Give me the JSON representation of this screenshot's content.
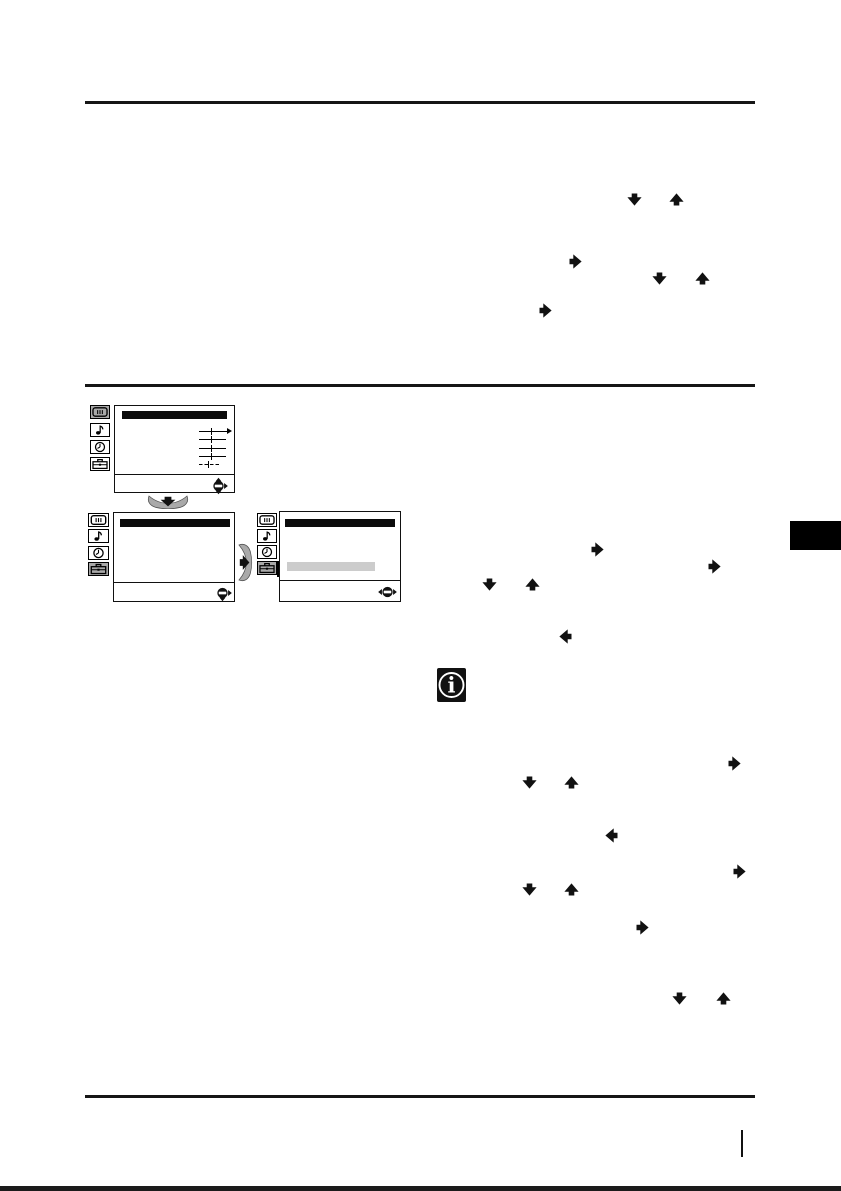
{
  "page": {
    "kind": "scanned TV instruction manual page",
    "background_color": "#ffffff",
    "ink_color": "#111111",
    "visible_text": "",
    "page_number_mark_glyph": "|"
  },
  "colors": {
    "selected_icon_background": "#a9a9a9",
    "menu_highlight_bar": "#cccccc",
    "fan_button_fill": "#a9a9a9",
    "chapter_tab": "#000000",
    "menu_title_bar": "#0b0b0b"
  },
  "osd_menus": [
    {
      "name": "picture-adjust-menu",
      "sidebar_icons": [
        "picture-menu-icon",
        "sound-menu-icon",
        "timer-menu-icon",
        "setup-menu-icon"
      ],
      "selected_icon": "picture",
      "title_bar": true,
      "slider_rows": [
        "arrow",
        "plain",
        "plain",
        "plain",
        "short"
      ],
      "highlight_bar": false,
      "joystick_arrows": [
        "up",
        "down",
        "right"
      ]
    },
    {
      "name": "setup-menu",
      "sidebar_icons": [
        "picture-menu-icon",
        "sound-menu-icon",
        "timer-menu-icon",
        "setup-menu-icon"
      ],
      "selected_icon": "setup",
      "title_bar": true,
      "slider_rows": [],
      "highlight_bar": false,
      "joystick_arrows": [
        "down",
        "right"
      ]
    },
    {
      "name": "setup-menu-item-highlighted",
      "sidebar_icons": [
        "picture-menu-icon",
        "sound-menu-icon",
        "timer-menu-icon",
        "setup-menu-icon"
      ],
      "selected_icon": "setup",
      "title_bar": true,
      "slider_rows": [],
      "highlight_bar": true,
      "joystick_arrows": [
        "left",
        "right"
      ]
    }
  ],
  "fan_buttons": [
    {
      "name": "joystick-press-down-button",
      "direction": "down"
    },
    {
      "name": "joystick-press-right-button",
      "direction": "right"
    }
  ],
  "inline_arrow_symbols": [
    {
      "direction": "down",
      "x": 635,
      "y": 200
    },
    {
      "direction": "up",
      "x": 677,
      "y": 200
    },
    {
      "direction": "right",
      "x": 576,
      "y": 262
    },
    {
      "direction": "down",
      "x": 660,
      "y": 279
    },
    {
      "direction": "up",
      "x": 703,
      "y": 279
    },
    {
      "direction": "right",
      "x": 546,
      "y": 311
    },
    {
      "direction": "right",
      "x": 598,
      "y": 550
    },
    {
      "direction": "right",
      "x": 715,
      "y": 567
    },
    {
      "direction": "down",
      "x": 490,
      "y": 585
    },
    {
      "direction": "up",
      "x": 533,
      "y": 585
    },
    {
      "direction": "left",
      "x": 566,
      "y": 637
    },
    {
      "direction": "right",
      "x": 735,
      "y": 764
    },
    {
      "direction": "down",
      "x": 530,
      "y": 783
    },
    {
      "direction": "up",
      "x": 572,
      "y": 783
    },
    {
      "direction": "left",
      "x": 612,
      "y": 836
    },
    {
      "direction": "right",
      "x": 740,
      "y": 872
    },
    {
      "direction": "down",
      "x": 530,
      "y": 890
    },
    {
      "direction": "up",
      "x": 572,
      "y": 890
    },
    {
      "direction": "right",
      "x": 643,
      "y": 928
    },
    {
      "direction": "down",
      "x": 680,
      "y": 999
    },
    {
      "direction": "up",
      "x": 724,
      "y": 999
    }
  ],
  "info_icon": {
    "glyph": "i"
  }
}
